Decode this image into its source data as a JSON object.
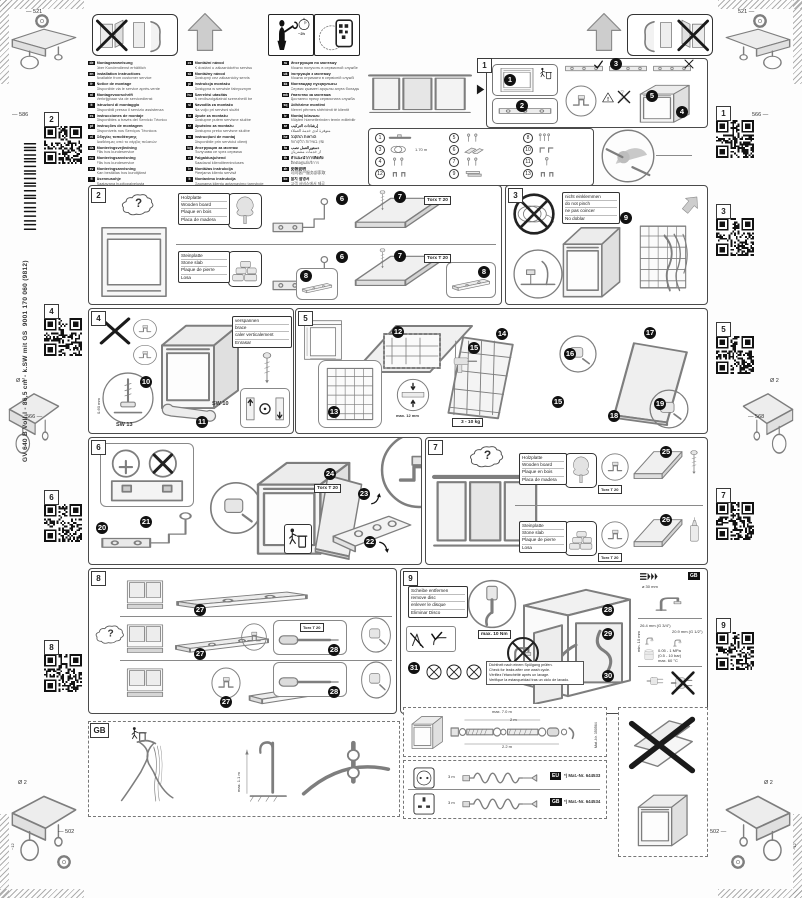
{
  "page": {
    "model": "GV 640 B  Voll-I - 86,5 cm - k.SW mit GS",
    "order_no": "9001 170 060 (9812)",
    "dims": {
      "top_left": "521",
      "top_right": "521",
      "left_upper": "586",
      "right_upper": "566",
      "left_mid": "566",
      "right_mid": "568",
      "bottom_left": "502",
      "bottom_right": "502",
      "drill": "Ø 2",
      "screw_len": "~12"
    }
  },
  "labels": {
    "torx": "Torx T 20",
    "sw13": "SW 13",
    "sw10": "SW 10",
    "feet_range": "0-60 mm",
    "thickness": "max. 12 mm",
    "weight": "3 - 10 kg",
    "torque": "max. 10 Nm",
    "hole": "ø 30 mm",
    "g34": "26.4 mm (G 3/4\")",
    "g12": "20.9 mm (G 1/2\")",
    "min10": "min. 10 mm",
    "pressure": "0.05 - 1 MPa",
    "pressure2": "(0.5 - 10 bar)",
    "temp": "max. 60 °C",
    "gb_ref": "GB",
    "time": "~2h",
    "hose_len": "1.70 m",
    "ext_total": "max. 7.0 m",
    "ext_a": "2 m",
    "ext_b": "2.2 m",
    "matnr_hose": "Mat.-Nr. 350564",
    "cable_len": "3 m",
    "chip_eu": "EU",
    "chip_gb": "GB",
    "matnr_eu": "*) Mat.-Nr. 644533",
    "matnr_gb": "*) Mat.-Nr. 644534",
    "gb_height": "max. 1.1 m",
    "gb_tag": "GB"
  },
  "qr": {
    "left": [
      "2",
      "4",
      "6",
      "8"
    ],
    "right": [
      "1",
      "3",
      "5",
      "7",
      "9"
    ]
  },
  "languages": {
    "col1": [
      {
        "c": "de",
        "a": "Montageanweisung",
        "b": "über Kundendienst erhältlich"
      },
      {
        "c": "en",
        "a": "Installation instructions",
        "b": "Available from customer service"
      },
      {
        "c": "fr",
        "a": "Notice de montage",
        "b": "Disponible via le service après-vente"
      },
      {
        "c": "nl",
        "a": "Montagevoorschrift",
        "b": "Verkrijgbaar via de servicedienst"
      },
      {
        "c": "it",
        "a": "Istruzioni di montaggio",
        "b": "Disponibili presso il servizio assistenza"
      },
      {
        "c": "es",
        "a": "Instrucciones de montaje",
        "b": "Disponibles a través del Servicio Técnico"
      },
      {
        "c": "pt",
        "a": "Instruções de montagem",
        "b": "Disponíveis nos Serviços Técnicos"
      },
      {
        "c": "el",
        "a": "Οδηγίες τοποθέτησης",
        "b": "Διαθέσιμες από το σέρβις πελατών"
      },
      {
        "c": "da",
        "a": "Monteringsvejledning",
        "b": "Fås hos kundeservice"
      },
      {
        "c": "no",
        "a": "Monteringsanvisning",
        "b": "Fås hos kundeservice"
      },
      {
        "c": "sv",
        "a": "Monteringsanvisning",
        "b": "Kan beställas hos kundtjänst"
      },
      {
        "c": "fi",
        "a": "Asennusohje",
        "b": "Saatavana huoltopalvelusta"
      }
    ],
    "col2": [
      {
        "c": "cs",
        "a": "Montážní návod",
        "b": "K dostání u zákaznického servisu"
      },
      {
        "c": "sk",
        "a": "Montážny návod",
        "b": "Dostupný cez zákaznícky servis"
      },
      {
        "c": "pl",
        "a": "Instrukcja montażu",
        "b": "Dostępna w serwisie fabrycznym"
      },
      {
        "c": "hu",
        "a": "Szerelési utasítás",
        "b": "A vevőszolgálatnál szerezhető be"
      },
      {
        "c": "sl",
        "a": "Navodila za montažo",
        "b": "Na voljo pri servisni službi"
      },
      {
        "c": "hr",
        "a": "Upute za montažu",
        "b": "Dostupne putem servisne službe"
      },
      {
        "c": "sr",
        "a": "Uputstvo za montažu",
        "b": "Dostupno preko servisne službe"
      },
      {
        "c": "ro",
        "a": "Instrucţiuni de montaj",
        "b": "Disponibile prin serviciul clienţi"
      },
      {
        "c": "bg",
        "a": "Инструкция за монтаж",
        "b": "Получава се чрез сервиза"
      },
      {
        "c": "et",
        "a": "Paigaldusjuhend",
        "b": "Saadaval klienditeeninduses"
      },
      {
        "c": "lv",
        "a": "Montāžas instrukcija",
        "b": "Pieejama klientu servisā"
      },
      {
        "c": "lt",
        "a": "Montavimo instrukcija",
        "b": "Gaunama klientų aptarnavimo tarnyboje"
      }
    ],
    "col3": [
      {
        "c": "ru",
        "a": "Инструкция по монтажу",
        "b": "Можно получить в сервисной службе"
      },
      {
        "c": "uk",
        "a": "Інструкція з монтажу",
        "b": "Можна отримати в сервісній службі"
      },
      {
        "c": "kk",
        "a": "Монтаждау нұсқаулығы",
        "b": "Сервис қызметі арқылы алуға болады"
      },
      {
        "c": "mk",
        "a": "Упатство за монтажа",
        "b": "Достапно преку сервисната служба"
      },
      {
        "c": "sq",
        "a": "Udhëzime montimi",
        "b": "Merret përmes shërbimit të klientit"
      },
      {
        "c": "tr",
        "a": "Montaj kılavuzu",
        "b": "Müşteri hizmetlerinden temin edilebilir"
      },
      {
        "c": "ar",
        "a": "إرشادات التركيب",
        "b": "متوفرة لدى خدمة العملاء"
      },
      {
        "c": "he",
        "a": "הוראות התקנה",
        "b": "זמין בשירות הלקוחות"
      },
      {
        "c": "fa",
        "a": "دستورالعمل نصب",
        "b": "از خدمات مشتریان"
      },
      {
        "c": "th",
        "a": "คำแนะนำการติดตั้ง",
        "b": "ติดต่อศูนย์บริการ"
      },
      {
        "c": "zh",
        "a": "安装说明",
        "b": "可向客户服务部索取"
      },
      {
        "c": "ko",
        "a": "설치 설명서",
        "b": "고객 서비스에서 제공"
      }
    ]
  },
  "parts": {
    "colA": [
      {
        "n": "1",
        "d": "rail",
        "note": ""
      },
      {
        "n": "3",
        "d": "coil",
        "note": "1.70 m"
      },
      {
        "n": "4",
        "d": "screws",
        "note": ""
      },
      {
        "n": "12",
        "d": "clips",
        "note": ""
      }
    ],
    "colB": [
      {
        "n": "5",
        "d": "screws",
        "note": ""
      },
      {
        "n": "6",
        "d": "wedges",
        "note": ""
      },
      {
        "n": "7",
        "d": "screws",
        "note": ""
      },
      {
        "n": "9",
        "d": "plates",
        "note": ""
      }
    ],
    "colC": [
      {
        "n": "8",
        "d": "screwset",
        "note": ""
      },
      {
        "n": "10",
        "d": "brackets",
        "note": ""
      },
      {
        "n": "11",
        "d": "screw1",
        "note": ""
      },
      {
        "n": "13",
        "d": "clips",
        "note": ""
      }
    ]
  },
  "panels": {
    "p1": {
      "num": "1",
      "steps": [
        "1",
        "2",
        "3",
        "4",
        "5"
      ]
    },
    "p2": {
      "num": "2",
      "wood": [
        "Holzplatte",
        "Wooden board",
        "Plaque en bois",
        "Placa de madera"
      ],
      "stone": [
        "Steinplatte",
        "Stone slab",
        "Plaque de pierre",
        "Losa"
      ],
      "steps": [
        "6",
        "7",
        "6",
        "7",
        "8",
        "8"
      ]
    },
    "p3": {
      "num": "3",
      "note": [
        "nicht einklemmen",
        "do not pinch",
        "ne pas coincer",
        "No doblar"
      ],
      "steps": [
        "9"
      ]
    },
    "p4": {
      "num": "4",
      "note": [
        "verspannen",
        "brace",
        "caler verticalement",
        "Enrasar"
      ],
      "steps": [
        "10",
        "11"
      ]
    },
    "p5": {
      "num": "5",
      "steps": [
        "12",
        "13",
        "14",
        "15",
        "15",
        "16",
        "17",
        "18",
        "19"
      ]
    },
    "p6": {
      "num": "6",
      "steps": [
        "20",
        "21",
        "22",
        "23",
        "24"
      ]
    },
    "p7": {
      "num": "7",
      "wood": [
        "Holzplatte",
        "Wooden board",
        "Plaque en bois",
        "Placa de madera"
      ],
      "stone": [
        "Steinplatte",
        "Stone slab",
        "Plaque de pierre",
        "Losa"
      ],
      "steps": [
        "25",
        "26"
      ]
    },
    "p8": {
      "num": "8",
      "steps": [
        "27",
        "27",
        "27",
        "28",
        "28"
      ]
    },
    "p9": {
      "num": "9",
      "disc": [
        "Scheibe entfernen",
        "remove disc",
        "enlever le disque",
        "Eliminar Disco"
      ],
      "check_note": [
        "Dichtheit nach einem Spülgang prüfen.",
        "Check for leaks after one wash cycle.",
        "Vérifiez l'étanchéité après un lavage.",
        "Verifique la estanqueidad tras un ciclo de lavado."
      ],
      "steps": [
        "28",
        "29",
        "30",
        "31"
      ]
    },
    "gb": {
      "num": "GB"
    }
  }
}
